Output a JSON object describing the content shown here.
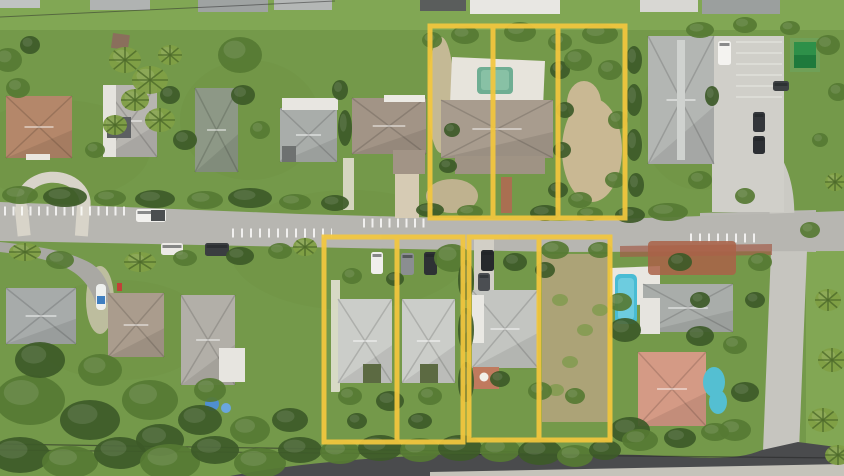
{
  "scene": {
    "type": "aerial-drone-photo",
    "description": "Bright aerial photo of a suburban residential block: two streets, single-family homes with gray/tan/salmon roofs, pools, parked cars, dense tree canopy, with yellow property-boundary overlays highlighting vacant and built lots",
    "palette": {
      "outline_yellow": "#F3C73E",
      "grass_green": "#74994A",
      "canopy_dark_green": "#3D5A28",
      "street_gray": "#B7B6B1",
      "asphalt_dark": "#4A4B4D",
      "concrete": "#D8D4C9",
      "roof_gray": "#CBCDC9",
      "roof_tan": "#B4876A",
      "roof_salmon": "#D49A85",
      "pool_blue": "#49BCD4",
      "pool_green": "#6FAE93",
      "sand": "#C9B893"
    }
  },
  "overlays": {
    "stroke_color": "#F3C73E",
    "stroke_width": 5,
    "opacity": 0.93,
    "groups": [
      {
        "name": "north-parcel-group",
        "outer": [
          430,
          26,
          195,
          192
        ],
        "dividers_x": [
          493,
          558
        ]
      },
      {
        "name": "southwest-parcel-group",
        "outer": [
          324,
          237,
          139,
          205
        ],
        "dividers_x": [
          397
        ]
      },
      {
        "name": "southeast-parcel-group",
        "outer": [
          469,
          237,
          141,
          203
        ],
        "dividers_x": [
          539
        ]
      }
    ],
    "group_count": 3,
    "lot_count": 7
  }
}
